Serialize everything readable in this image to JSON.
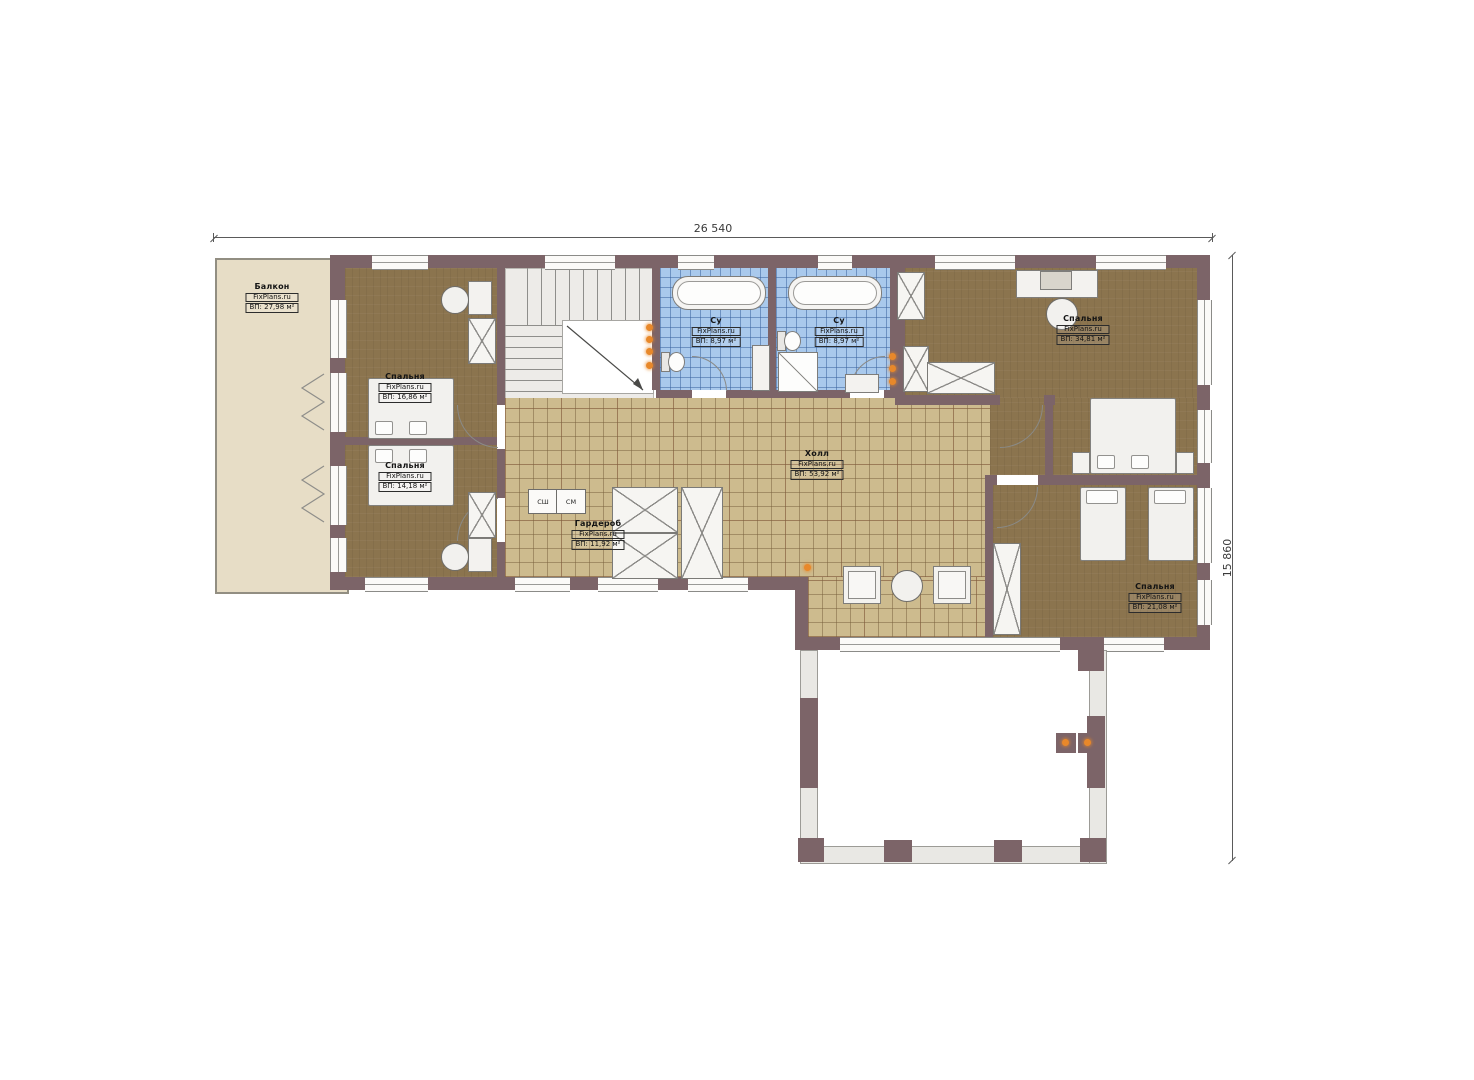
{
  "colors": {
    "wall": "#7c6468",
    "bedroom": "#8b744e",
    "hall": "#cdbb8e",
    "bath": "#a9c9ec",
    "balcony": "#e7ddc6",
    "accent": "#e8882a"
  },
  "dimensions": {
    "top": "26 540",
    "right": "15 860"
  },
  "watermark": "FixPlans.ru",
  "rooms": [
    {
      "id": "balcony",
      "name": "Балкон",
      "area": "ВП: 27,98 м²"
    },
    {
      "id": "bedroom-tl",
      "name": "Спальня",
      "area": "ВП: 16,86 м²"
    },
    {
      "id": "bedroom-bl",
      "name": "Спальня",
      "area": "ВП: 14,18 м²"
    },
    {
      "id": "bath-1",
      "name": "Су",
      "area": "ВП: 8,97 м²"
    },
    {
      "id": "bath-2",
      "name": "Су",
      "area": "ВП: 8,97 м²"
    },
    {
      "id": "bedroom-tr",
      "name": "Спальня",
      "area": "ВП: 34,81 м²"
    },
    {
      "id": "hall",
      "name": "Холл",
      "area": "ВП: 53,92 м²"
    },
    {
      "id": "wardrobe",
      "name": "Гардероб",
      "area": "ВП: 11,92 м²"
    },
    {
      "id": "bedroom-br",
      "name": "Спальня",
      "area": "ВП: 21,08 м²"
    }
  ],
  "appliances": {
    "dryer": "СШ",
    "washer": "СМ"
  }
}
